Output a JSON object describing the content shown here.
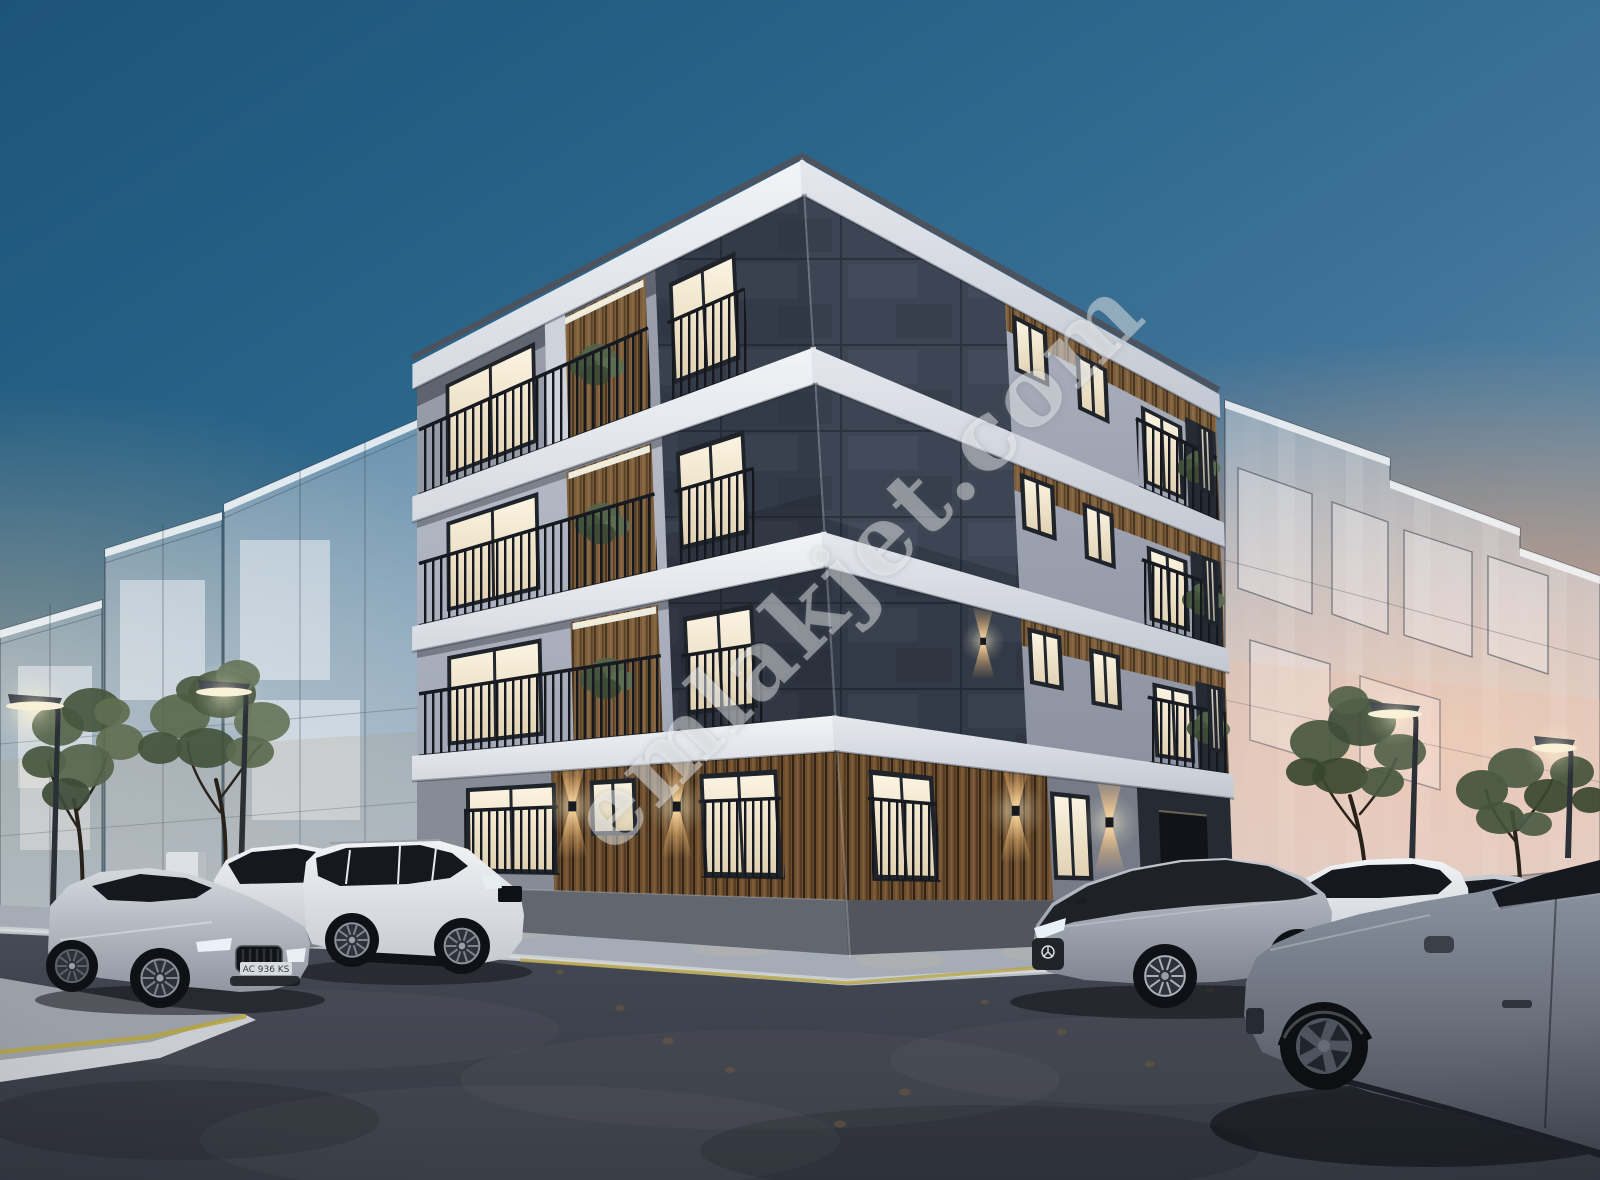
{
  "watermark": {
    "text": "emlakjet.com",
    "color": "#ffffff",
    "opacity": 0.42,
    "angle_deg": -45
  },
  "scene": {
    "type": "architectural-render",
    "time_of_day": "dusk",
    "description": "3D real-estate rendering of a modern four-storey corner apartment building with charcoal slate corner column, light grey facades, wood-slat ground floor with warm up/down sconce lights, balconies with dark vertical railings and potted green plants; translucent concept glass buildings on both sides; corner street with parked cars, street lamps and young trees under a dusk sky with sunset glow.",
    "license_plate": "AC 936 KS",
    "building": {
      "storeys": 4,
      "materials": [
        "charcoal slate tiles",
        "light grey plaster",
        "white slab bands",
        "vertical wood slats",
        "black metal railings"
      ],
      "lighting": [
        "warm lit windows",
        "up/down wall sconces",
        "balcony ceiling strips"
      ]
    },
    "vehicles": [
      "silver BMW sedan",
      "white SUV",
      "white Range Rover Sport",
      "two-tone Mercedes EQS",
      "white BMW X5",
      "silver compact sedan",
      "foreground grey sedan (cropped)"
    ],
    "street_furniture": [
      "curved street lamps",
      "young trees",
      "shrubs",
      "utility cabinet",
      "yellow curb stripe"
    ]
  },
  "palette": {
    "sky_top": "#1d5379",
    "sky_mid": "#417499",
    "sunset": "#f3a676",
    "haze": "#c4b098",
    "facade_left": "#b7bcc9",
    "facade_right": "#a7adbb",
    "slab": "#eceef2",
    "stone": "#343b48",
    "stone_right": "#3d4453",
    "wood": "#7b5d3c",
    "wood_ground": "#6b4c2d",
    "wood_gap": "#2e2315",
    "window_warm": "#fbf4e1",
    "window_frame": "#1f232a",
    "railing": "#14171d",
    "asphalt": "#41454f",
    "sidewalk": "#a6acb5",
    "curb": "#d6d9dd",
    "curb_yellow": "#b5a33c",
    "ghost_glass": "#eef2f6",
    "ghost_line": "#3a4655",
    "tree_green": "#53644a",
    "tree_green_dark": "#43523b",
    "trunk": "#27211a",
    "car_silver": "#c3c8cf",
    "car_white": "#eaecef",
    "car_dark_top": "#1e2126",
    "car_foreground": "#858c99",
    "glass_dark": "#15181e",
    "lamp_light": "#f6efd8",
    "sconce_warm": "#ffc478",
    "shadow": "#0a0c10"
  }
}
